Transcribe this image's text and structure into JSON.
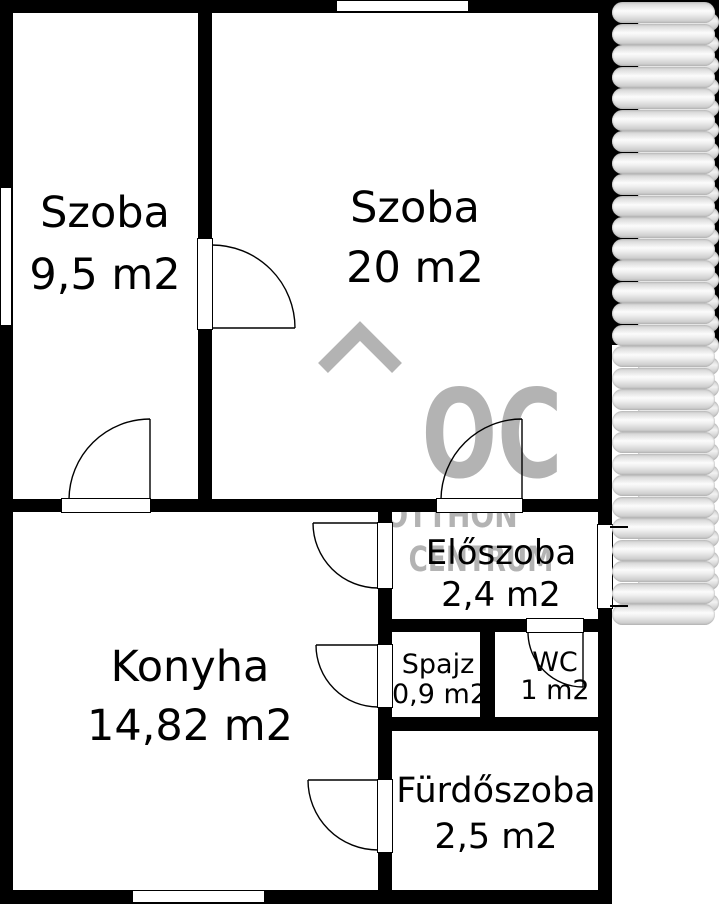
{
  "plan": {
    "rooms": [
      {
        "name": "Szoba",
        "area": "9,5 m2"
      },
      {
        "name": "Szoba",
        "area": "20 m2"
      },
      {
        "name": "Konyha",
        "area": "14,82 m2"
      },
      {
        "name": "Előszoba",
        "area": "2,4 m2"
      },
      {
        "name": "Spajz",
        "area": "0,9 m2"
      },
      {
        "name": "WC",
        "area": "1 m2"
      },
      {
        "name": "Fürdőszoba",
        "area": "2,5 m2"
      }
    ]
  },
  "watermark": {
    "logo": "OC",
    "line1": "OTTHON",
    "line2": "CENTRUM",
    "color": "#b3b3b3"
  },
  "decor": {
    "spiral_segments": 29
  },
  "colors": {
    "wall": "#000000",
    "floor": "#ffffff"
  }
}
